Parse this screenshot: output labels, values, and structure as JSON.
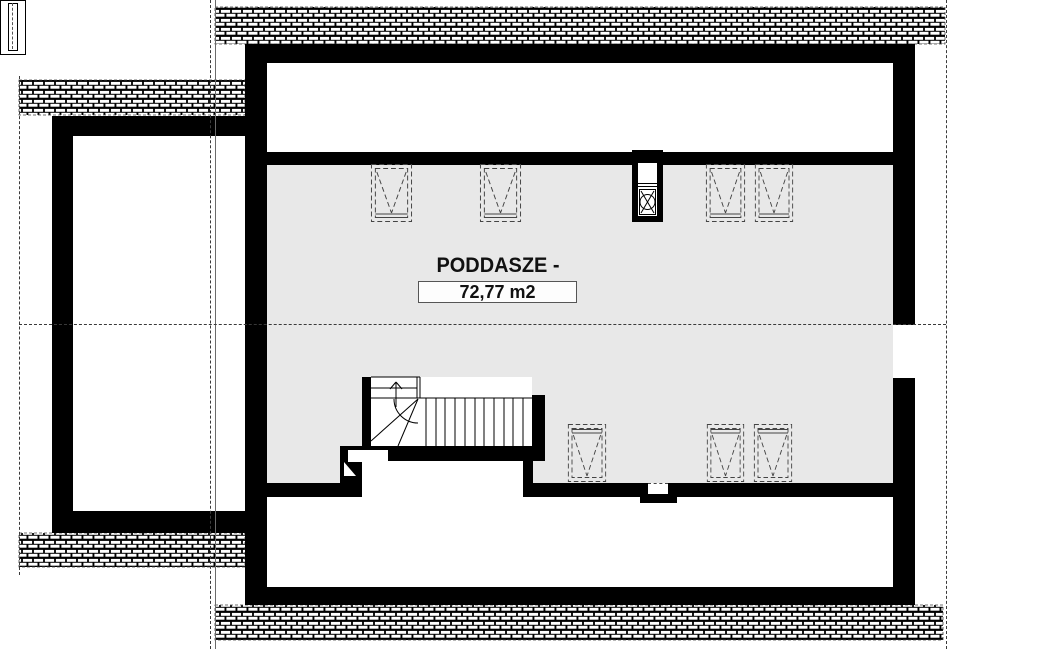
{
  "plan": {
    "title": "PODDASZE - OPCJA",
    "area": "72,77 m2"
  },
  "colors": {
    "wall": "#000000",
    "floor_fill": "#e8e8e8",
    "background": "#ffffff",
    "guide_line": "#3a3a3a"
  }
}
